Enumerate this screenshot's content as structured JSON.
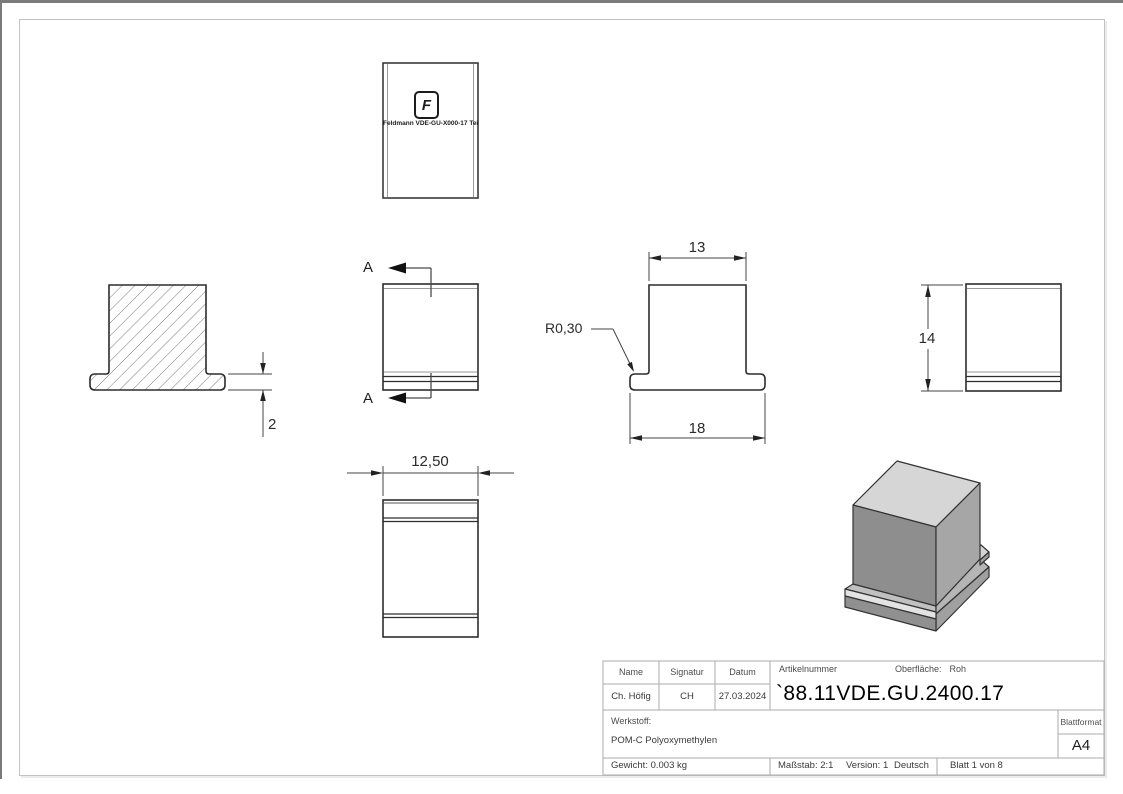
{
  "drawing": {
    "logo": {
      "letter": "F",
      "caption": "Feldmann VDE-GU-X000-17 Teil1"
    },
    "section_marker": "A",
    "dimensions": {
      "flange_height": "2",
      "top_width": "13",
      "base_width": "18",
      "corner_radius": "R0,30",
      "height": "14",
      "depth": "12,50"
    }
  },
  "title_block": {
    "headers": {
      "name": "Name",
      "signature": "Signatur",
      "date": "Datum"
    },
    "values": {
      "name": "Ch. Höfig",
      "signature": "CH",
      "date": "27.03.2024"
    },
    "article": {
      "label": "Artikelnummer",
      "number": "`88.11VDE.GU.2400.17"
    },
    "surface": {
      "label": "Oberfläche:",
      "value": "Roh"
    },
    "material": {
      "label": "Werkstoff:",
      "value": "POM-C Polyoxymethylen"
    },
    "sheet_format": {
      "label": "Blattformat",
      "value": "A4"
    },
    "weight": "Gewicht: 0.003 kg",
    "scale": "Maßstab: 2:1",
    "version": "Version: 1",
    "language": "Deutsch",
    "sheet": "Blatt 1 von 8"
  },
  "colors": {
    "outline": "#2d2d2d",
    "frame": "#c3c3c3",
    "table_border": "#ababab",
    "iso_top": "#d6d6d6",
    "iso_left": "#8e8e8e",
    "iso_right": "#a6a6a6",
    "iso_chamfer": "#e3e3e3"
  }
}
